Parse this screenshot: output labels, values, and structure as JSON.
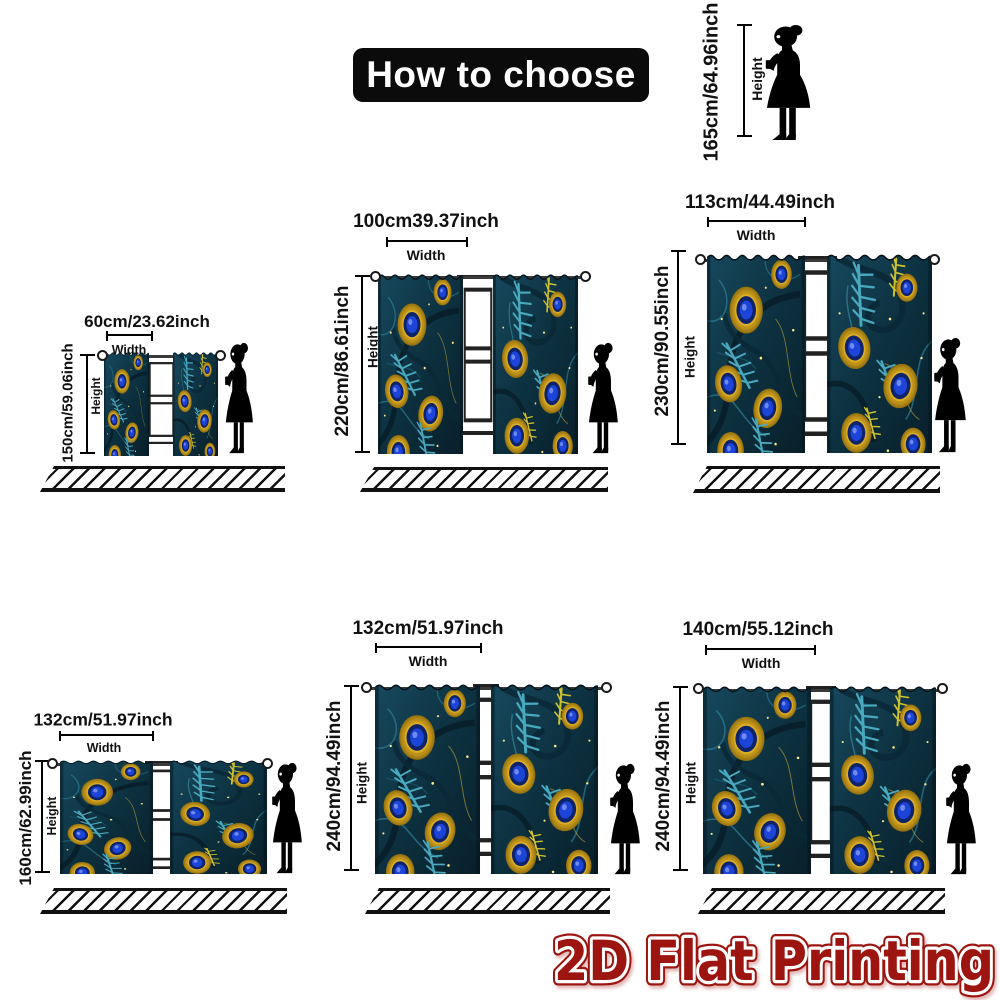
{
  "title": "How to choose",
  "reference_person": {
    "size_text": "165cm/64.96inch",
    "height_label": "Height"
  },
  "diagrams": [
    {
      "width_text": "60cm/23.62inch",
      "width_label": "Width",
      "height_text": "150cm/59.06inch",
      "height_label": "Height"
    },
    {
      "width_text": "100cm39.37inch",
      "width_label": "Width",
      "height_text": "220cm/86.61inch",
      "height_label": "Height"
    },
    {
      "width_text": "113cm/44.49inch",
      "width_label": "Width",
      "height_text": "230cm/90.55inch",
      "height_label": "Height"
    },
    {
      "width_text": "132cm/51.97inch",
      "width_label": "Width",
      "height_text": "160cm/62.99inch",
      "height_label": "Height"
    },
    {
      "width_text": "132cm/51.97inch",
      "width_label": "Width",
      "height_text": "240cm/94.49inch",
      "height_label": "Height"
    },
    {
      "width_text": "140cm/55.12inch",
      "width_label": "Width",
      "height_text": "240cm/94.49inch",
      "height_label": "Height"
    }
  ],
  "footer": {
    "text": "2D Flat Printing"
  },
  "colors": {
    "banner_bg": "#0b0b0b",
    "banner_text": "#ffffff",
    "footer_red": "#9c1511",
    "curtain_teal_dark": "#0d3140",
    "curtain_teal": "#2c7f97",
    "feather_gold": "#eebc2a",
    "eye_blue": "#1d44d8",
    "measure_line": "#000000"
  }
}
